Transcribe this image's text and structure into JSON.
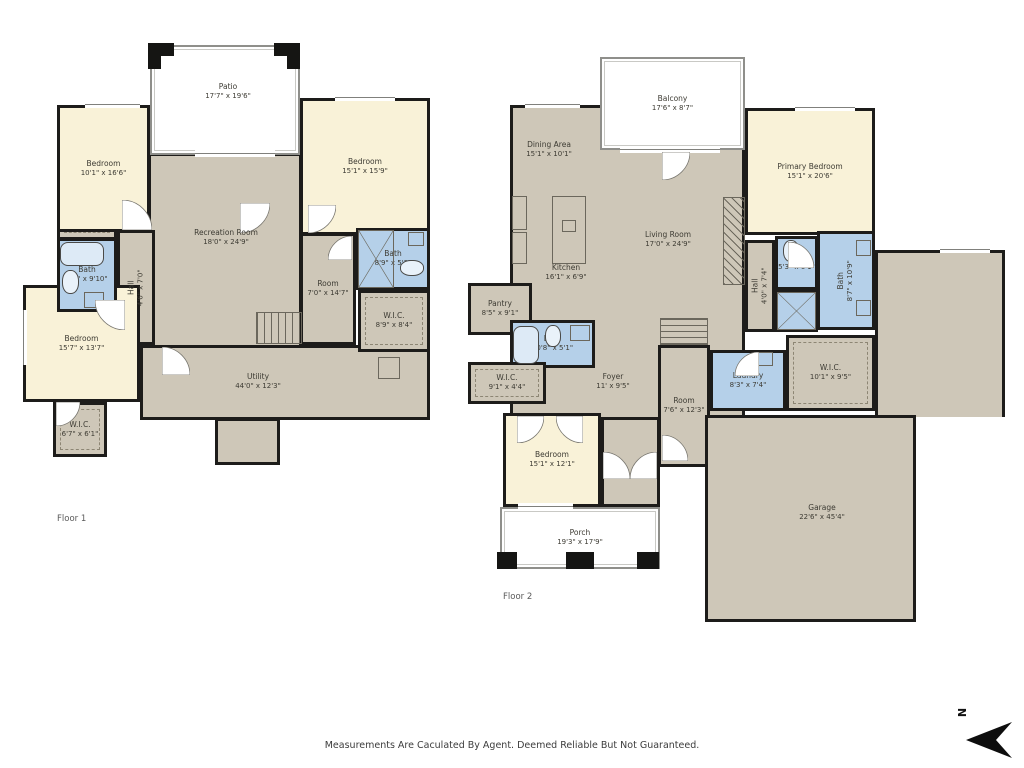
{
  "meta": {
    "disclaimer": "Measurements Are Caculated By Agent. Deemed Reliable But Not Guaranteed.",
    "compass_label": "N"
  },
  "palette": {
    "wall": "#1d1c1a",
    "common": "#cec7b8",
    "bedroom": "#f9f2d8",
    "bath": "#b5d0e9",
    "outdoor": "#ffffff",
    "label_text": "#3d3b33"
  },
  "floors": [
    {
      "name": "floor-1",
      "label": {
        "text": "Floor 1",
        "x": 57,
        "y": 514
      },
      "rooms": [
        {
          "name": "recreation-room",
          "type": "common",
          "x": 148,
          "y": 153,
          "w": 154,
          "h": 212
        },
        {
          "name": "utility-main",
          "type": "common",
          "x": 140,
          "y": 345,
          "w": 290,
          "h": 75
        },
        {
          "name": "utility-notch",
          "type": "common",
          "x": 215,
          "y": 418,
          "w": 65,
          "h": 47
        },
        {
          "name": "hall-f1",
          "type": "common",
          "x": 117,
          "y": 230,
          "w": 38,
          "h": 115,
          "label": "Hall",
          "dims": "4'6\" x 7'0\"",
          "rot": 1
        },
        {
          "name": "room-f1",
          "type": "common",
          "x": 300,
          "y": 233,
          "w": 56,
          "h": 112,
          "label": "Room",
          "dims": "7'0\" x 14'7\""
        },
        {
          "name": "closet-strip",
          "type": "wic",
          "x": 57,
          "y": 220,
          "w": 60,
          "h": 20
        },
        {
          "name": "bedroom-top-left",
          "type": "bedroom",
          "x": 57,
          "y": 105,
          "w": 93,
          "h": 127,
          "label": "Bedroom",
          "dims": "10'1\" x 16'6\""
        },
        {
          "name": "bedroom-top-right",
          "type": "bedroom",
          "x": 300,
          "y": 98,
          "w": 130,
          "h": 137,
          "label": "Bedroom",
          "dims": "15'1\" x 15'9\""
        },
        {
          "name": "bedroom-bottom-left",
          "type": "bedroom",
          "x": 23,
          "y": 285,
          "w": 117,
          "h": 117,
          "label": "Bedroom",
          "dims": "15'7\" x 13'7\""
        },
        {
          "name": "bath-f1-left",
          "type": "bath",
          "x": 57,
          "y": 238,
          "w": 60,
          "h": 74,
          "label": "Bath",
          "dims": "6'2\" x 9'10\""
        },
        {
          "name": "bath-f1-right",
          "type": "bath",
          "x": 356,
          "y": 228,
          "w": 74,
          "h": 62,
          "label": "Bath",
          "dims": "8'9\" x 5'3\""
        },
        {
          "name": "wic-f1-right",
          "type": "wic",
          "x": 358,
          "y": 290,
          "w": 72,
          "h": 62,
          "label": "W.I.C.",
          "dims": "8'9\" x 8'4\""
        },
        {
          "name": "wic-f1-left",
          "type": "wic",
          "x": 53,
          "y": 402,
          "w": 54,
          "h": 55,
          "label": "W.I.C.",
          "dims": "6'7\" x 6'1\""
        },
        {
          "name": "patio",
          "type": "outdoor",
          "x": 150,
          "y": 45,
          "w": 150,
          "h": 110
        }
      ],
      "areas": [
        {
          "name": "patio-label",
          "label": "Patio",
          "dims": "17'7\" x 19'6\"",
          "x": 228,
          "y": 92
        },
        {
          "name": "recreation-label",
          "label": "Recreation Room",
          "dims": "18'0\" x 24'9\"",
          "x": 226,
          "y": 238
        },
        {
          "name": "utility-label",
          "label": "Utility",
          "dims": "44'0\" x 12'3\"",
          "x": 258,
          "y": 382
        }
      ],
      "features": [
        {
          "t": "stairs-v",
          "x": 256,
          "y": 312,
          "w": 46,
          "h": 32
        },
        {
          "t": "box",
          "x": 378,
          "y": 357,
          "w": 22,
          "h": 22
        },
        {
          "t": "tub",
          "x": 60,
          "y": 242,
          "w": 44,
          "h": 24
        },
        {
          "t": "toilet",
          "x": 62,
          "y": 270,
          "w": 17,
          "h": 24
        },
        {
          "t": "box",
          "x": 84,
          "y": 292,
          "w": 20,
          "h": 16
        },
        {
          "t": "xbox",
          "x": 358,
          "y": 230,
          "w": 36,
          "h": 58
        },
        {
          "t": "toilet",
          "x": 400,
          "y": 260,
          "w": 24,
          "h": 16
        },
        {
          "t": "box",
          "x": 408,
          "y": 232,
          "w": 16,
          "h": 14
        }
      ],
      "windows": [
        {
          "x": 85,
          "y": 101,
          "w": 55,
          "h": 7
        },
        {
          "x": 335,
          "y": 94,
          "w": 60,
          "h": 7
        },
        {
          "x": 195,
          "y": 150,
          "w": 80,
          "h": 7
        },
        {
          "x": 20,
          "y": 310,
          "w": 7,
          "h": 55
        }
      ],
      "posts": [
        {
          "x": 148,
          "y": 43,
          "w": 26,
          "h": 13
        },
        {
          "x": 148,
          "y": 43,
          "w": 13,
          "h": 26
        },
        {
          "x": 274,
          "y": 43,
          "w": 26,
          "h": 13
        },
        {
          "x": 287,
          "y": 43,
          "w": 13,
          "h": 26
        }
      ],
      "doors": [
        {
          "h": "bl",
          "x": 122,
          "y": 200,
          "s": 30
        },
        {
          "h": "tl",
          "x": 240,
          "y": 203,
          "s": 30
        },
        {
          "h": "tl",
          "x": 308,
          "y": 205,
          "s": 28
        },
        {
          "h": "tr",
          "x": 95,
          "y": 300,
          "s": 30
        },
        {
          "h": "bl",
          "x": 162,
          "y": 347,
          "s": 28
        },
        {
          "h": "tl",
          "x": 56,
          "y": 402,
          "s": 24
        },
        {
          "h": "br",
          "x": 328,
          "y": 236,
          "s": 24
        }
      ]
    },
    {
      "name": "floor-2",
      "label": {
        "text": "Floor 2",
        "x": 503,
        "y": 592
      },
      "rooms": [
        {
          "name": "living-block",
          "type": "common",
          "x": 510,
          "y": 105,
          "w": 235,
          "h": 315
        },
        {
          "name": "foyer-ext",
          "type": "common",
          "x": 601,
          "y": 417,
          "w": 59,
          "h": 90
        },
        {
          "name": "room-f2",
          "type": "common",
          "x": 658,
          "y": 345,
          "w": 52,
          "h": 122,
          "label": "Room",
          "dims": "7'6\" x 12'3\""
        },
        {
          "name": "hall-f2",
          "type": "common",
          "x": 745,
          "y": 240,
          "w": 30,
          "h": 92,
          "label": "Hall",
          "dims": "4'0\" x 7'4\"",
          "rot": 1
        },
        {
          "name": "garage-top",
          "type": "common",
          "x": 875,
          "y": 250,
          "w": 130,
          "h": 167,
          "nb": "b"
        },
        {
          "name": "garage-main",
          "type": "common",
          "x": 705,
          "y": 415,
          "w": 211,
          "h": 207
        },
        {
          "name": "primary-bedroom",
          "type": "bedroom",
          "x": 745,
          "y": 108,
          "w": 130,
          "h": 127,
          "label": "Primary Bedroom",
          "dims": "15'1\" x 20'6\""
        },
        {
          "name": "bedroom-f2",
          "type": "bedroom",
          "x": 503,
          "y": 413,
          "w": 98,
          "h": 94,
          "label": "Bedroom",
          "dims": "15'1\" x 12'1\""
        },
        {
          "name": "pantry",
          "type": "common",
          "x": 468,
          "y": 283,
          "w": 64,
          "h": 52,
          "label": "Pantry",
          "dims": "8'5\" x 9'1\""
        },
        {
          "name": "bath-f2-main",
          "type": "bath",
          "x": 510,
          "y": 320,
          "w": 85,
          "h": 48,
          "label": "Bath",
          "dims": "10'8\" x 5'1\""
        },
        {
          "name": "wic-f2-left",
          "type": "wic",
          "x": 468,
          "y": 362,
          "w": 78,
          "h": 42,
          "label": "W.I.C.",
          "dims": "9'1\" x 4'4\""
        },
        {
          "name": "laundry",
          "type": "bath",
          "x": 710,
          "y": 350,
          "w": 76,
          "h": 61,
          "label": "Laundry",
          "dims": "8'3\" x 7'4\""
        },
        {
          "name": "wic-f2-right",
          "type": "wic",
          "x": 786,
          "y": 335,
          "w": 89,
          "h": 76,
          "label": "W.I.C.",
          "dims": "10'1\" x 9'5\""
        },
        {
          "name": "bath-f2-small",
          "type": "bath",
          "x": 775,
          "y": 236,
          "w": 43,
          "h": 54,
          "label": "Bath",
          "dims": "5'3\" x 6'1\""
        },
        {
          "name": "shower-area",
          "type": "bath",
          "x": 775,
          "y": 290,
          "w": 43,
          "h": 42
        },
        {
          "name": "bath-f2-primary",
          "type": "bath",
          "x": 817,
          "y": 231,
          "w": 58,
          "h": 99,
          "label": "Bath",
          "dims": "8'7\" x 10'9\"",
          "rot": 1
        },
        {
          "name": "balcony",
          "type": "outdoor",
          "x": 600,
          "y": 57,
          "w": 145,
          "h": 93,
          "label": "Balcony",
          "dims": "17'6\" x 8'7\""
        },
        {
          "name": "porch",
          "type": "outdoor",
          "x": 500,
          "y": 507,
          "w": 160,
          "h": 62,
          "label": "Porch",
          "dims": "19'3\" x 17'9\""
        }
      ],
      "areas": [
        {
          "name": "dining-label",
          "label": "Dining Area",
          "dims": "15'1\" x 10'1\"",
          "x": 549,
          "y": 150
        },
        {
          "name": "living-label",
          "label": "Living Room",
          "dims": "17'0\" x 24'9\"",
          "x": 668,
          "y": 240
        },
        {
          "name": "kitchen-label",
          "label": "Kitchen",
          "dims": "16'1\" x 6'9\"",
          "x": 566,
          "y": 273
        },
        {
          "name": "foyer-label",
          "label": "Foyer",
          "dims": "11' x 9'5\"",
          "x": 613,
          "y": 382
        },
        {
          "name": "garage-label",
          "label": "Garage",
          "dims": "22'6\" x 45'4\"",
          "x": 822,
          "y": 513
        }
      ],
      "features": [
        {
          "t": "hatch",
          "x": 723,
          "y": 197,
          "w": 22,
          "h": 88
        },
        {
          "t": "stairs-h",
          "x": 660,
          "y": 318,
          "w": 48,
          "h": 27
        },
        {
          "t": "box",
          "x": 552,
          "y": 196,
          "w": 34,
          "h": 68
        },
        {
          "t": "box",
          "x": 562,
          "y": 220,
          "w": 14,
          "h": 12
        },
        {
          "t": "box",
          "x": 512,
          "y": 196,
          "w": 15,
          "h": 34
        },
        {
          "t": "box",
          "x": 512,
          "y": 232,
          "w": 15,
          "h": 32
        },
        {
          "t": "tub",
          "x": 513,
          "y": 326,
          "w": 26,
          "h": 38
        },
        {
          "t": "toilet",
          "x": 545,
          "y": 325,
          "w": 16,
          "h": 22
        },
        {
          "t": "box",
          "x": 570,
          "y": 325,
          "w": 20,
          "h": 16
        },
        {
          "t": "xbox",
          "x": 777,
          "y": 292,
          "w": 39,
          "h": 38
        },
        {
          "t": "toilet",
          "x": 783,
          "y": 240,
          "w": 16,
          "h": 22
        },
        {
          "t": "box",
          "x": 856,
          "y": 240,
          "w": 15,
          "h": 16
        },
        {
          "t": "box",
          "x": 856,
          "y": 300,
          "w": 15,
          "h": 16
        },
        {
          "t": "box",
          "x": 757,
          "y": 352,
          "w": 16,
          "h": 14
        }
      ],
      "windows": [
        {
          "x": 525,
          "y": 101,
          "w": 55,
          "h": 7
        },
        {
          "x": 620,
          "y": 146,
          "w": 100,
          "h": 7
        },
        {
          "x": 795,
          "y": 104,
          "w": 60,
          "h": 7
        },
        {
          "x": 518,
          "y": 503,
          "w": 55,
          "h": 7
        },
        {
          "x": 940,
          "y": 246,
          "w": 50,
          "h": 7
        }
      ],
      "posts": [
        {
          "x": 497,
          "y": 552,
          "w": 20,
          "h": 17
        },
        {
          "x": 566,
          "y": 552,
          "w": 28,
          "h": 17
        },
        {
          "x": 637,
          "y": 552,
          "w": 22,
          "h": 17
        }
      ],
      "doors": [
        {
          "h": "tl",
          "x": 662,
          "y": 152,
          "s": 28
        },
        {
          "h": "bl",
          "x": 788,
          "y": 242,
          "s": 26
        },
        {
          "h": "tl",
          "x": 517,
          "y": 416,
          "s": 27
        },
        {
          "h": "tr",
          "x": 556,
          "y": 416,
          "s": 27
        },
        {
          "h": "bl",
          "x": 603,
          "y": 452,
          "s": 27
        },
        {
          "h": "br",
          "x": 630,
          "y": 452,
          "s": 27
        },
        {
          "h": "br",
          "x": 735,
          "y": 352,
          "s": 24
        },
        {
          "h": "bl",
          "x": 662,
          "y": 435,
          "s": 26
        }
      ]
    }
  ],
  "compass": {
    "letter_x": 957,
    "letter_y": 706,
    "arrow_x": 966,
    "arrow_y": 718
  }
}
